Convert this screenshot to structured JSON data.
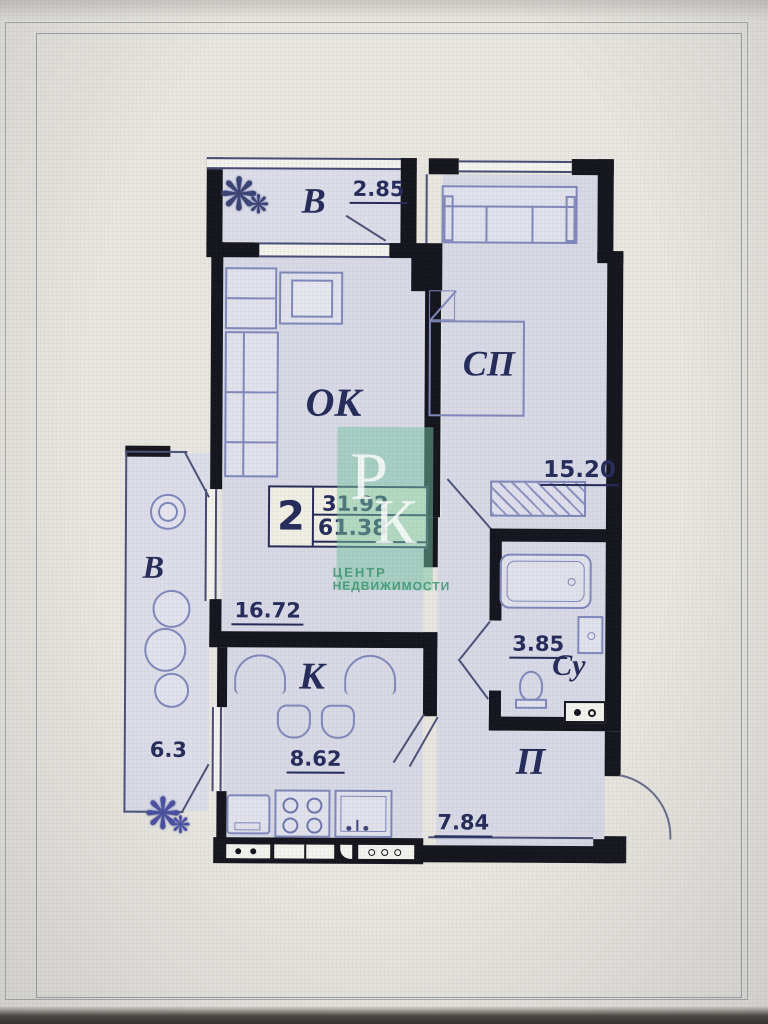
{
  "plan": {
    "stamp": {
      "rooms_count": "2",
      "area_living": "31.92",
      "area_total": "61.38"
    },
    "rooms": {
      "balcony_top": {
        "label": "В",
        "area": "2.85"
      },
      "bedroom": {
        "label": "СП",
        "area": "15.20"
      },
      "living": {
        "label": "ОК",
        "area": "16.72"
      },
      "balcony_left": {
        "label": "В",
        "area": "6.3"
      },
      "kitchen": {
        "label": "К",
        "area": "8.62"
      },
      "bathroom": {
        "label": "Су",
        "area": "3.85"
      },
      "hallway": {
        "label": "П",
        "area": "7.84"
      }
    },
    "watermark": {
      "letter_p": "Р",
      "letter_k": "К",
      "line1": "ЦЕНТР",
      "line2": "НЕДВИЖИМОСТИ"
    },
    "icons": {
      "plant": "❋"
    }
  },
  "colors": {
    "wall": "#15151d",
    "room_fill": "#d8d9e5",
    "label": "#262c59",
    "furniture": "#8088ba",
    "watermark_green": "#76c4a0"
  }
}
